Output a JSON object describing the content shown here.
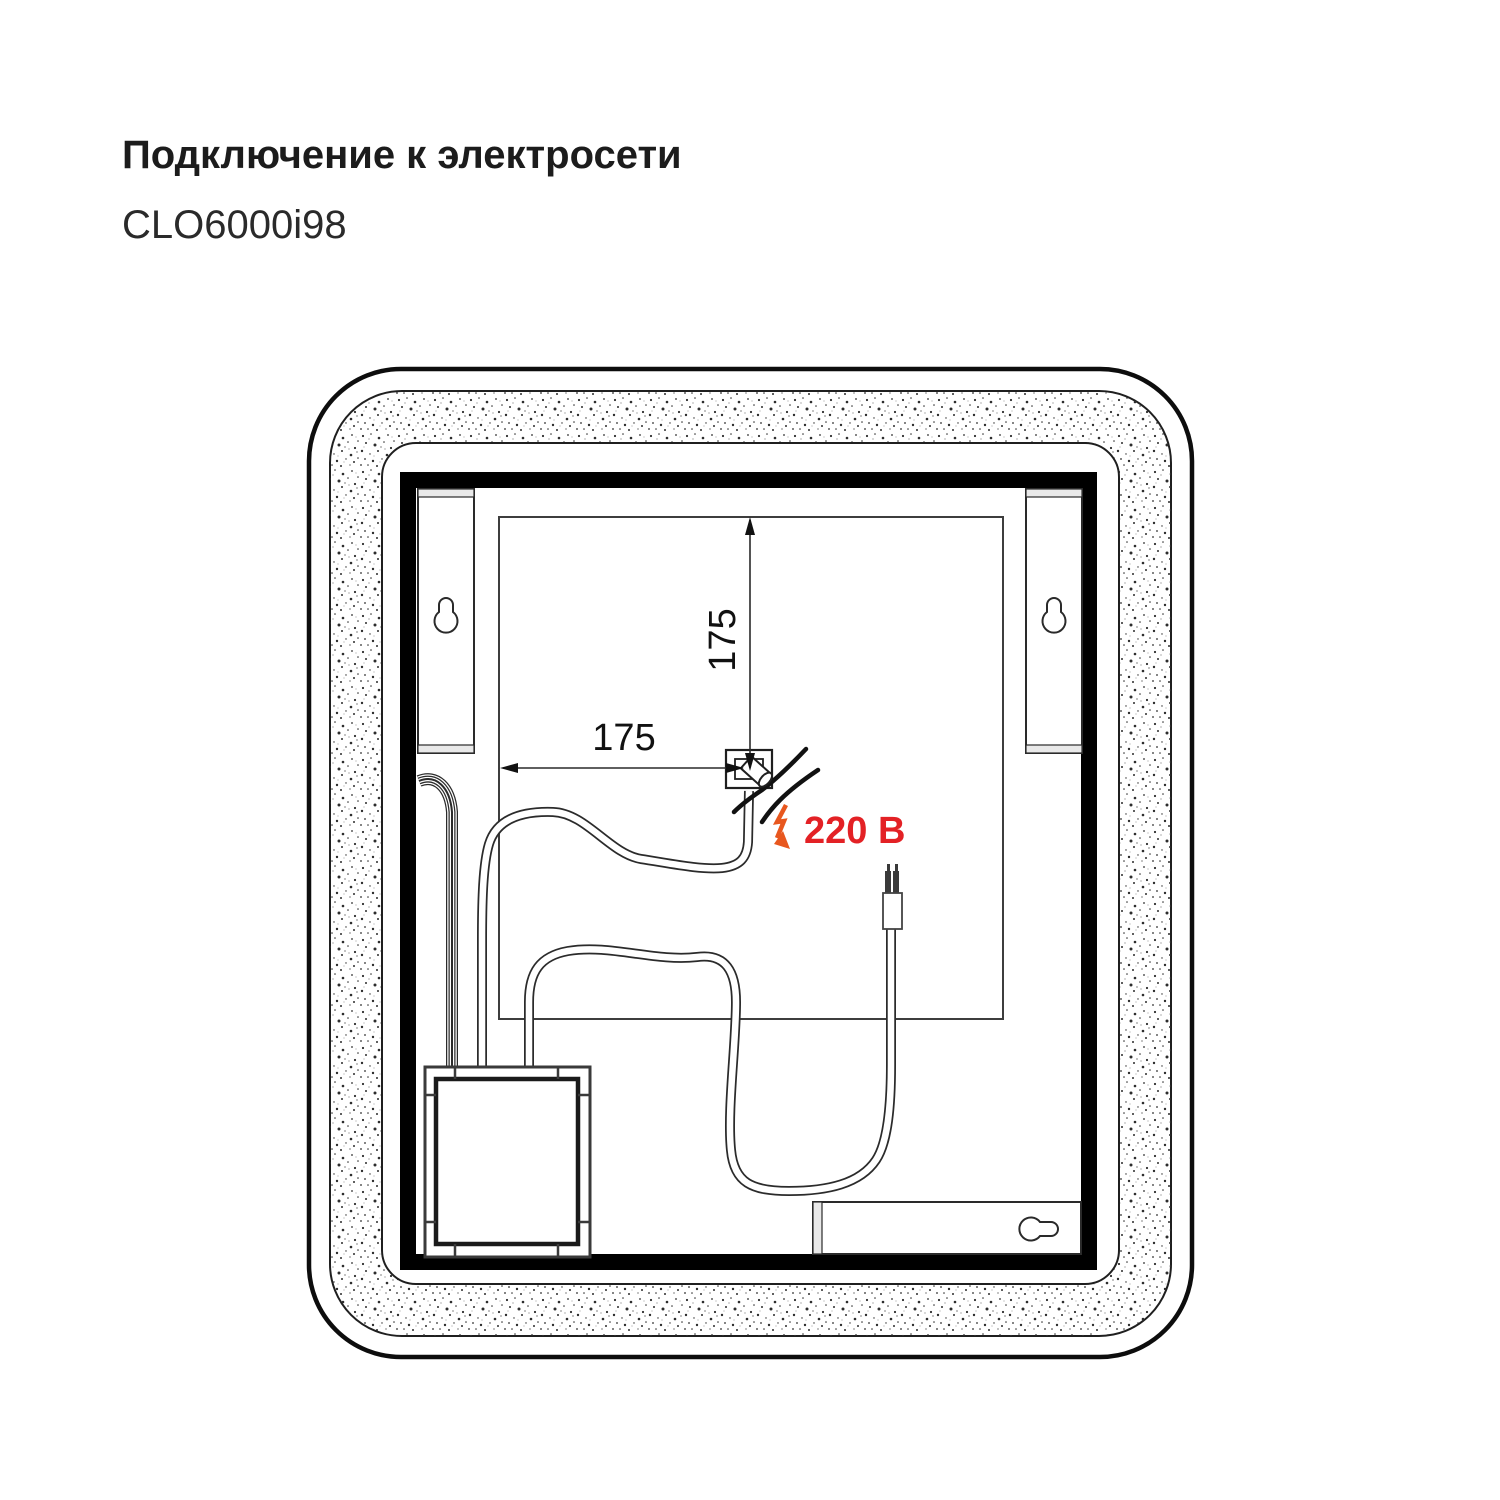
{
  "header": {
    "title": "Подключение к электросети",
    "model": "CLO6000i98"
  },
  "diagram": {
    "dimensions": {
      "vertical": "175",
      "horizontal": "175"
    },
    "voltage": {
      "label": "220 В",
      "color": "#E32125"
    },
    "colors": {
      "line": "#1f1f1f",
      "frame": "#000000",
      "lightning": "#E8571E",
      "speckle": "#2d2d2d"
    },
    "icons": {
      "keyhole": "keyhole-slot-icon",
      "lightning": "lightning-arrow-icon"
    }
  }
}
